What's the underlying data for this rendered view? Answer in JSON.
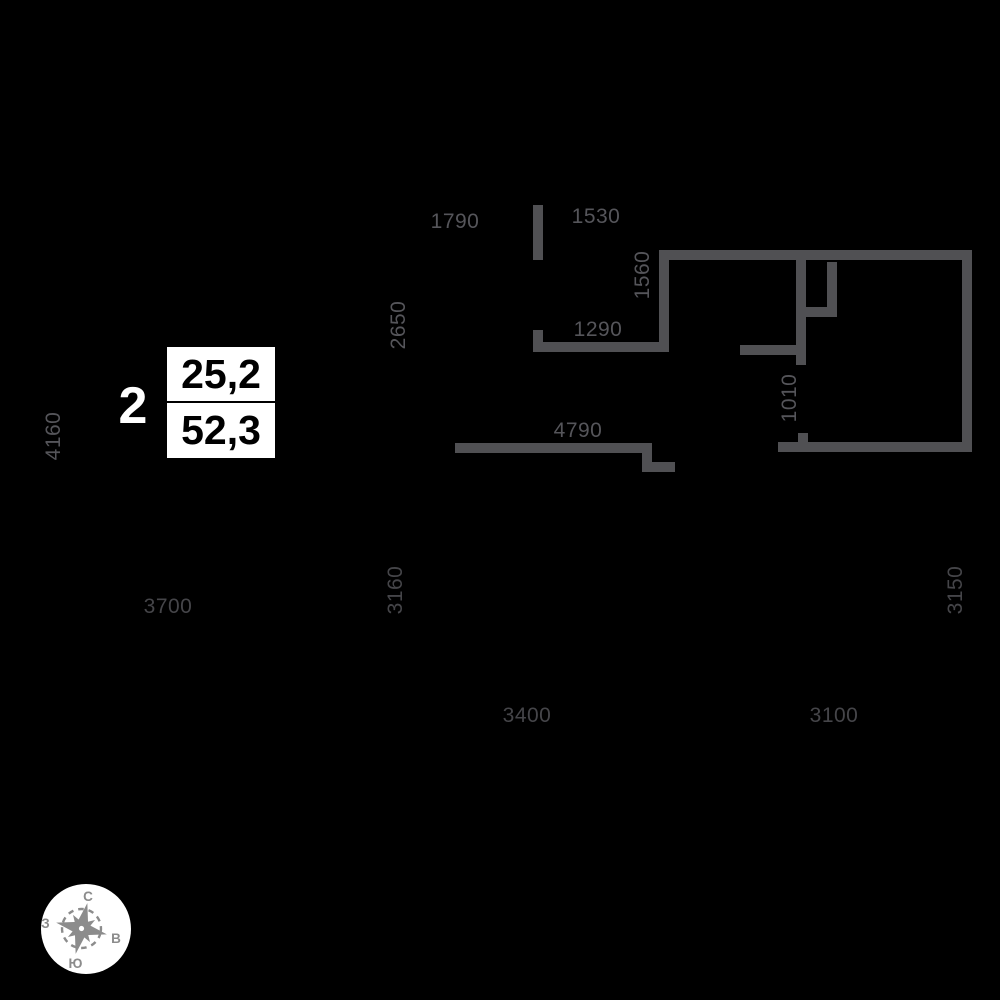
{
  "plan": {
    "unit": {
      "number": "2",
      "living_area": "25,2",
      "total_area": "52,3"
    },
    "background_color": "#000000",
    "wall_color": "#505053",
    "walls": [
      {
        "x": 533,
        "y": 205,
        "w": 10,
        "h": 55
      },
      {
        "x": 533,
        "y": 330,
        "w": 10,
        "h": 22
      },
      {
        "x": 533,
        "y": 342,
        "w": 136,
        "h": 10
      },
      {
        "x": 659,
        "y": 251,
        "w": 10,
        "h": 101
      },
      {
        "x": 659,
        "y": 250,
        "w": 313,
        "h": 10
      },
      {
        "x": 796,
        "y": 260,
        "w": 10,
        "h": 105
      },
      {
        "x": 827,
        "y": 262,
        "w": 10,
        "h": 55
      },
      {
        "x": 806,
        "y": 307,
        "w": 31,
        "h": 10
      },
      {
        "x": 740,
        "y": 345,
        "w": 66,
        "h": 10
      },
      {
        "x": 798,
        "y": 433,
        "w": 10,
        "h": 10
      },
      {
        "x": 778,
        "y": 442,
        "w": 194,
        "h": 10
      },
      {
        "x": 962,
        "y": 250,
        "w": 10,
        "h": 202
      },
      {
        "x": 455,
        "y": 443,
        "w": 197,
        "h": 10
      },
      {
        "x": 642,
        "y": 443,
        "w": 10,
        "h": 29
      },
      {
        "x": 642,
        "y": 462,
        "w": 33,
        "h": 10
      }
    ]
  },
  "dimensions": {
    "color_light": "#55555a",
    "color_dark": "#454549",
    "items": [
      {
        "value": "1790",
        "x": 455,
        "y": 222,
        "vertical": false,
        "shade": "light"
      },
      {
        "value": "1530",
        "x": 596,
        "y": 217,
        "vertical": false,
        "shade": "light"
      },
      {
        "value": "2650",
        "x": 399,
        "y": 325,
        "vertical": true,
        "shade": "light"
      },
      {
        "value": "1560",
        "x": 643,
        "y": 275,
        "vertical": true,
        "shade": "light"
      },
      {
        "value": "1290",
        "x": 598,
        "y": 330,
        "vertical": false,
        "shade": "light"
      },
      {
        "value": "4160",
        "x": 54,
        "y": 436,
        "vertical": true,
        "shade": "light"
      },
      {
        "value": "4790",
        "x": 578,
        "y": 431,
        "vertical": false,
        "shade": "light"
      },
      {
        "value": "1010",
        "x": 790,
        "y": 398,
        "vertical": true,
        "shade": "light"
      },
      {
        "value": "3700",
        "x": 168,
        "y": 607,
        "vertical": false,
        "shade": "dark"
      },
      {
        "value": "3160",
        "x": 396,
        "y": 590,
        "vertical": true,
        "shade": "dark"
      },
      {
        "value": "3150",
        "x": 956,
        "y": 590,
        "vertical": true,
        "shade": "dark"
      },
      {
        "value": "3400",
        "x": 527,
        "y": 716,
        "vertical": false,
        "shade": "dark"
      },
      {
        "value": "3100",
        "x": 834,
        "y": 716,
        "vertical": false,
        "shade": "dark"
      }
    ]
  },
  "compass": {
    "north": "С",
    "south": "Ю",
    "west": "З",
    "east": "В",
    "rose_color": "#8c8c8c",
    "bg_color": "#ffffff"
  }
}
